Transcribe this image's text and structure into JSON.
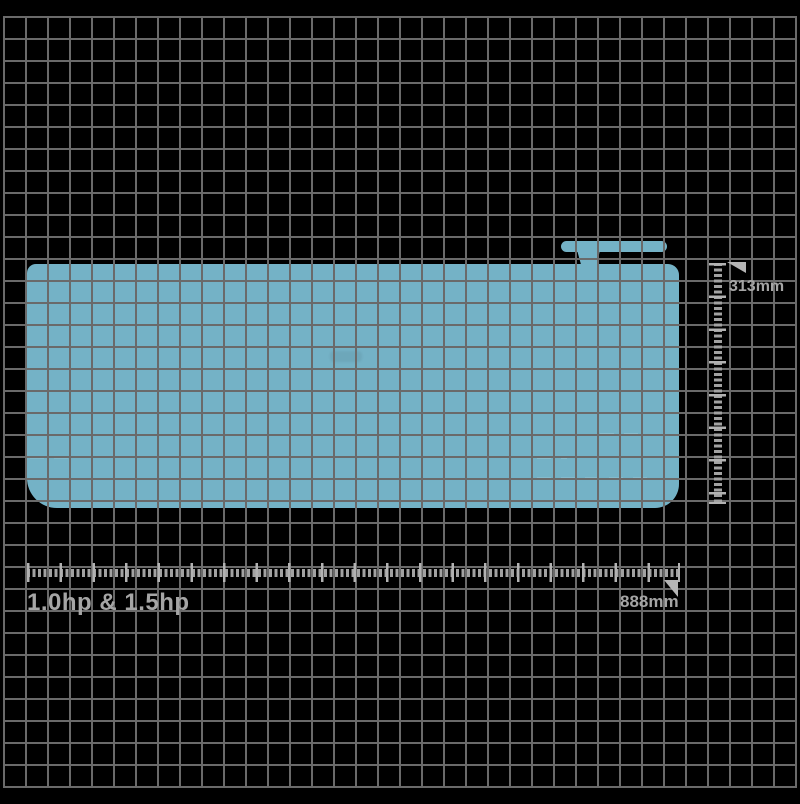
{
  "page": {
    "type": "product-dimension-diagram",
    "background_color": "#000000"
  },
  "grid": {
    "color": "#6a6a6a",
    "cell_px": 22
  },
  "unit": {
    "name": "air-conditioner-indoor-unit-silhouette",
    "fill_color": "#74b2c6"
  },
  "annotations": {
    "ruler_color": "#b2b2b2",
    "arrow_color": "#b5b5b5",
    "text_color": "#a5a5a5",
    "height_dimension": {
      "label": "313mm"
    },
    "width_dimension": {
      "label": "888mm"
    },
    "caption": {
      "label": "1.0hp & 1.5hp"
    },
    "icons": {
      "height_arrow": "dimension-arrowhead",
      "width_arrow": "dimension-arrowhead"
    }
  }
}
